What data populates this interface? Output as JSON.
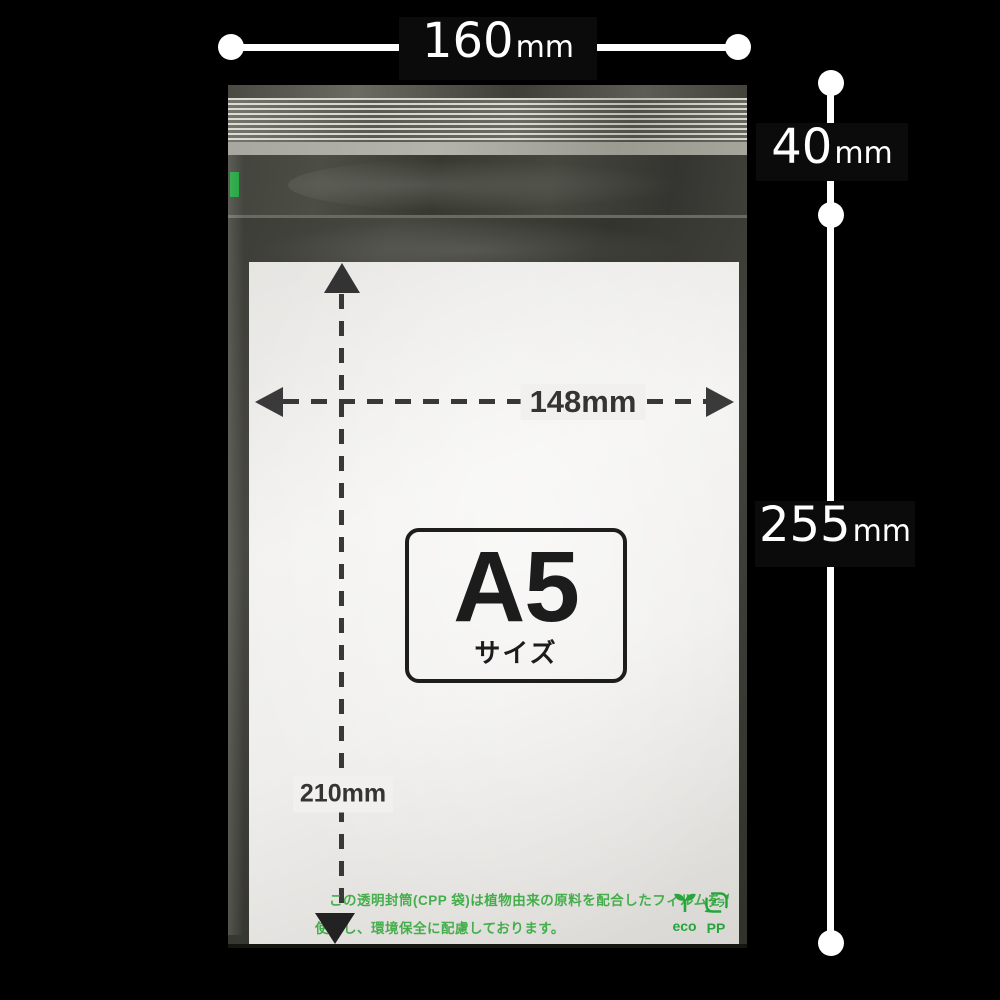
{
  "dims": {
    "width": {
      "value": "160",
      "unit": "mm"
    },
    "flap": {
      "value": "40",
      "unit": "mm"
    },
    "height": {
      "value": "255",
      "unit": "mm"
    },
    "inner_width": {
      "value": "148",
      "unit": "mm"
    },
    "inner_height": {
      "value": "210",
      "unit": "mm"
    }
  },
  "paper_label": {
    "size": "A5",
    "suffix": "サイズ"
  },
  "eco_note": {
    "line1": "この透明封筒(CPP 袋)は植物由来の原料を配合したフィルムを",
    "line2": "使用し、環境保全に配慮しております。",
    "eco_label": "eco",
    "pp_label": "PP",
    "pp_mark": "プラ"
  },
  "colors": {
    "background": "#000000",
    "annotation_white": "#ffffff",
    "label_box": "#0b0b0b",
    "print_dark": "#383838",
    "green_text": "#45ae4c",
    "green_icon": "#27a53d",
    "tamper_seal_green": "#1fa33c"
  }
}
